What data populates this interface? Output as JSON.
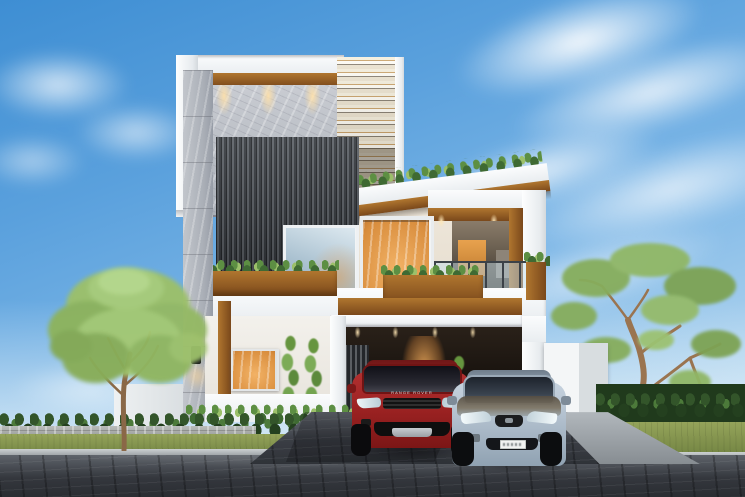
{
  "meta": {
    "title": "Modern two-storey villa exterior – 3D architectural render",
    "description": "Daytime 3D visualization of a modern white, wood and marble house with roof plants, balcony, carport, two parked SUVs, trees and a dark paved street in front."
  },
  "labels": {
    "scene": "architectural render of a modern villa",
    "sky": "blue sky with wispy clouds",
    "house": "modern two-storey villa",
    "marble_column": "marble clad column with wall lamp",
    "louver_screen": "dark vertical louver facade panel",
    "slat_screen": "hanging horizontal slat screen",
    "roof_garden": "roof edge planting over wooden fascia",
    "balcony": "balcony with glass railing and wood lined frame",
    "planter": "wooden planter box with shrubs",
    "upper_window": "upper floor window with warm interior light",
    "ground_window": "ground floor window with warm interior light",
    "carport": "covered carport with downlights",
    "entrance": "warm lit entrance door",
    "wall_lamp": "black up-down wall sconce",
    "gate_wall": "white compound gate wall",
    "left_tree": "broad green deciduous tree",
    "right_tree": "slender twisted-trunk tree",
    "hedge_left": "shrub row along left boundary",
    "hedge_right": "dense dark hedge on right boundary",
    "bollard": "small white boundary post",
    "grass": "grass verge",
    "road": "dark cobblestone street",
    "driveway": "paved driveway in front of carport",
    "ramp": "light concrete ramp to street",
    "red_suv": "red luxury compact SUV parked in carport",
    "silver_suv": "silver-blue crossover SUV parked on driveway",
    "license_plate": "white license plate (text illegible)",
    "vines": "tall climbing plants on front wall",
    "downlights": "warm facade downlights"
  },
  "text": {
    "red_suv_hood_badge": "RANGE ROVER"
  },
  "colors": {
    "sky_top": "#3e8ed3",
    "sky_mid": "#7ab5e6",
    "sky_horizon": "#cfe6f4",
    "cloud": "#ffffff",
    "wall_white": "#f4f6f8",
    "marble": "#b4b9c1",
    "wood_light": "#b0762f",
    "wood_dark": "#7a481b",
    "louver": "#3a3e43",
    "warm_light": "#f2b266",
    "glass_cool": "#abc2d1",
    "foliage_light": "#9cc06a",
    "foliage_dark": "#3f6a33",
    "hedge": "#33552a",
    "grass": "#95a45a",
    "trunk": "#8a6847",
    "road_dark": "#2a2d32",
    "road_light": "#5e636a",
    "carport_dark": "#16110d",
    "car_red": "#9e2323",
    "car_silver": "#b3c1cf",
    "plate_white": "#f2f3f2"
  }
}
